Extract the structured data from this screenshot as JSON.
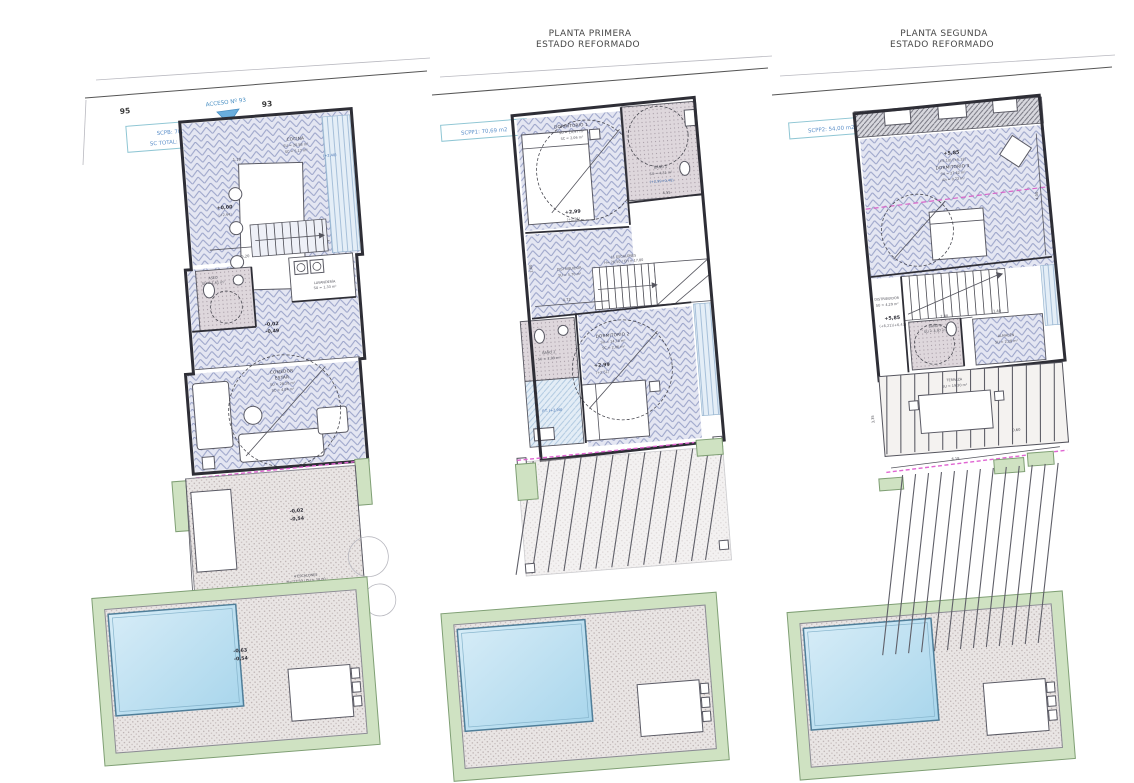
{
  "colors": {
    "background": "#ffffff",
    "wall": "#2e2e36",
    "floor_hatch_blue": "#99a2c8",
    "terrace_green": "#cfe2c2",
    "pool_blue": "#a9d6ec",
    "magenta_line": "#d964c9",
    "annotation_blue": "#3f6db0",
    "label_box_teal": "#8fc6d4"
  },
  "titles": {
    "plan2": {
      "line1": "PLANTA PRIMERA",
      "line2": "ESTADO REFORMADO"
    },
    "plan3": {
      "line1": "PLANTA SEGUNDA",
      "line2": "ESTADO REFORMADO"
    }
  },
  "plan1": {
    "street_left": "95",
    "street_right": "93",
    "access_label": "ACCESO Nº 93",
    "area_line1": "SCPB: 70,94 m2",
    "area_line2": "SC TOTAL: 195,26 m2",
    "cocina": {
      "name": "COCINA",
      "su": "SU = 20,58 m²",
      "sc": "SC = 5,17 m²"
    },
    "dim_table": "1,19",
    "level_kitchen": {
      "main": "+0,00",
      "sub": "(+2,64)"
    },
    "closet_note": "(+2,40)",
    "lavanderia": {
      "name": "LAVANDERÍA",
      "su": "SU = 1,33 m²"
    },
    "aseo": {
      "name": "ASEO",
      "su": "SU = 1,61 m²"
    },
    "level_hall": {
      "main": "-0,02",
      "sub": "-0,49"
    },
    "dim_kitchen": "5,08",
    "dim_hall": "5,20",
    "estar": {
      "name1": "COMEDOR",
      "name2": "ESTAR",
      "su": "SU = 28,20 m²",
      "sc": "SC = 4,04 m²"
    },
    "level_terrace": {
      "main": "-0,02",
      "sub": "-0,54"
    },
    "steps": {
      "line1": "4 ESCALONES",
      "line2": "H= 22,50 / CH = 18,00"
    },
    "level_pool": {
      "main": "-0,63",
      "sub": "-0,54"
    }
  },
  "plan2": {
    "area_line1": "SCPP1: 70,69 m2",
    "dorm1": {
      "name": "DORMITORIO 1",
      "su": "SU = 10,97 m²",
      "sc": "SC = 2,06 m²"
    },
    "bano1": {
      "name": "BAÑO 1",
      "su": "SU = 4,31 m²",
      "note": "(+2,99+0,45)"
    },
    "dim_bano1": "4,55",
    "level_dorm1": {
      "main": "+2,99",
      "sub": "(+2,51)"
    },
    "stairs": {
      "line1": "11 ESCALONES",
      "line2": "H= 26,50 / CH = 17,80"
    },
    "distribuidor": {
      "name": "DISTRIBUIDOR",
      "su": "SU = 5,70 m²"
    },
    "dim_corridor": "4,72",
    "dim_corridor_v": "1,80",
    "bano2": {
      "name": "BAÑO 2",
      "su": "SU = 2,09 m²",
      "note": "P.T. (+2,90)"
    },
    "dorm2": {
      "name": "DORMITORIO 2",
      "su": "SU = 14,76 m²",
      "sc": "SC = 2,06 m²"
    },
    "level_dorm2": {
      "main": "+2,99",
      "sub": "(+2,51)"
    }
  },
  "plan3": {
    "area_line1": "SCPP2: 54,00 m2",
    "level_top": {
      "main": "+5,85",
      "sub": "(+6,10)/(+6,32)"
    },
    "dorm3": {
      "name": "DORMITORIO 3",
      "su": "SU = 27,42 m²",
      "ah": "Ah = 0,72 m²"
    },
    "dim_right": "4,00",
    "distribuidor": {
      "name": "DISTRIBUIDOR",
      "su": "SU = 4,29 m²"
    },
    "level_mid": {
      "main": "+5,85",
      "sub": "(+6,21)(+6,43)"
    },
    "bano3": {
      "name": "BAÑO 3",
      "su": "SU = 4,97 m²"
    },
    "almacen": {
      "name": "ALMACÉN",
      "su": "SU = 2,28 m²"
    },
    "dim_stairs": "2,40",
    "dim_stairs2": "1,40",
    "terraza": {
      "name": "TERRAZA",
      "su": "SU = 19,30 m²"
    },
    "dim_terrace_v": "3,35",
    "dim_terrace_h": "6,19",
    "dim_terrace_s": "0,60"
  }
}
